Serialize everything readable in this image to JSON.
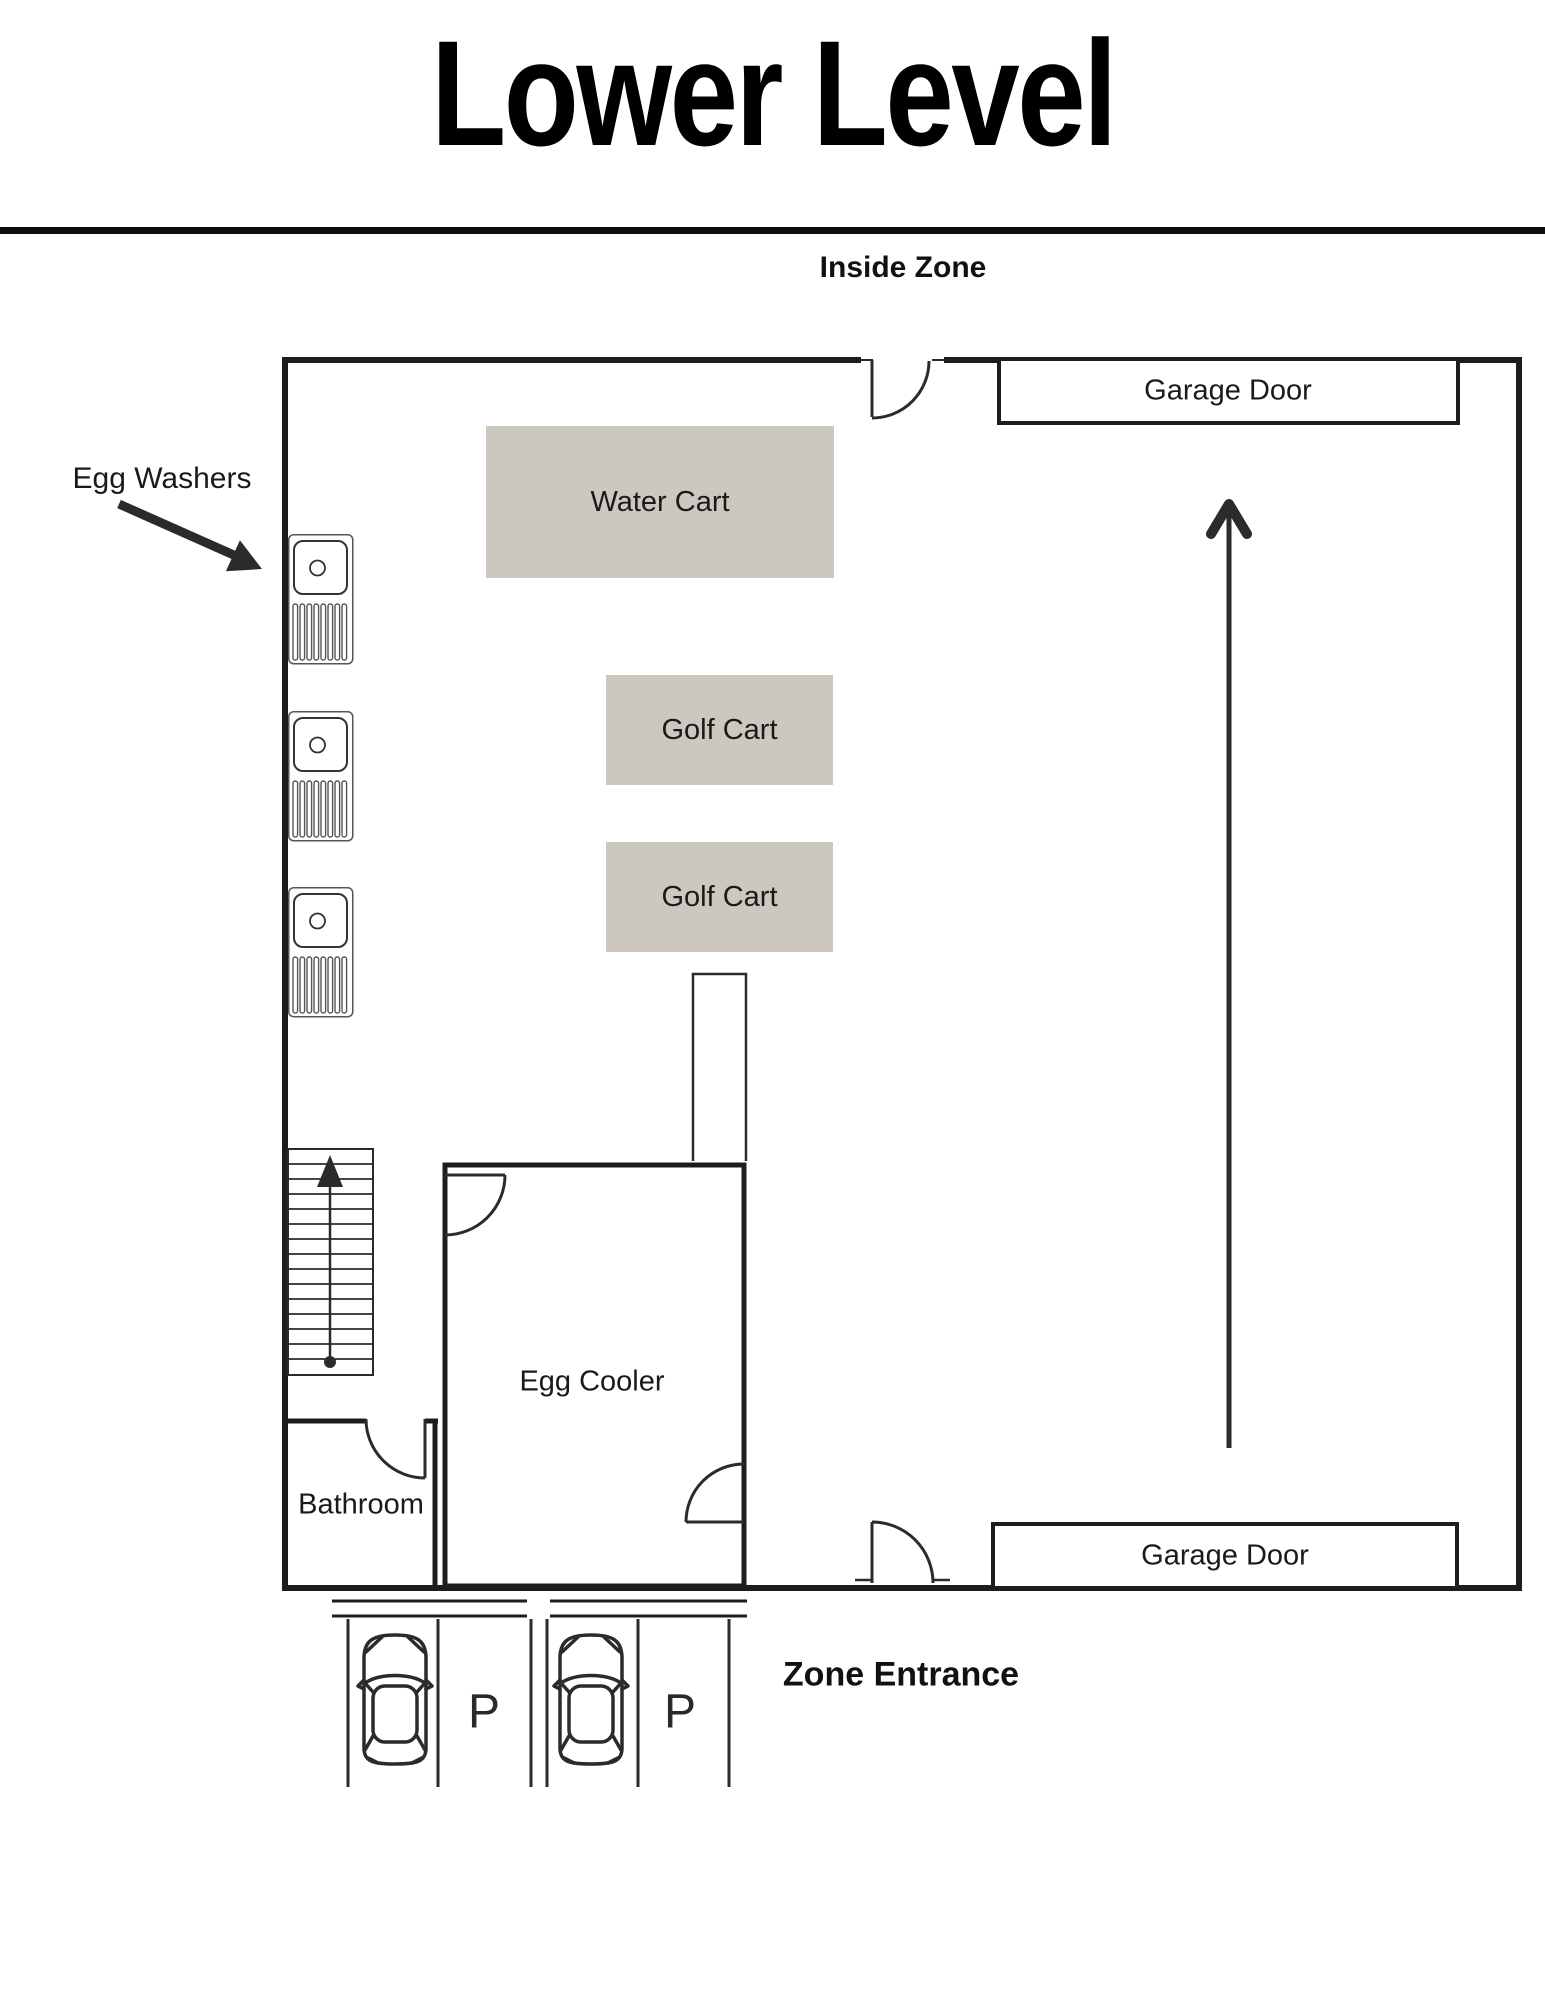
{
  "page": {
    "title": "Lower Level"
  },
  "zone": {
    "label": "Inside Zone",
    "entrance": "Zone Entrance"
  },
  "rooms": {
    "egg_cooler": "Egg Cooler",
    "bathroom": "Bathroom"
  },
  "fixtures": {
    "garage_door_top": "Garage Door",
    "garage_door_bottom": "Garage Door",
    "water_cart": "Water Cart",
    "golf_cart_1": "Golf Cart",
    "golf_cart_2": "Golf Cart",
    "egg_washers": "Egg Washers"
  },
  "parking": {
    "space_1": "P",
    "space_2": "P"
  },
  "icons": {
    "egg_washer_sink": "sink-icon",
    "parking_car": "car-top-view-icon",
    "traffic_flow": "up-arrow-icon",
    "stairs_direction": "stairs-up-arrow-icon",
    "egg_washers_pointer": "pointer-arrow-icon",
    "door_swings": "door-swing-icon"
  },
  "colors": {
    "wall_color": "#1D1D1D",
    "line_color": "#2B2B2B",
    "cart_fill": "#CCC8C0",
    "divider_color": "#0D0D0D",
    "text_color": "#1A1A1A"
  }
}
